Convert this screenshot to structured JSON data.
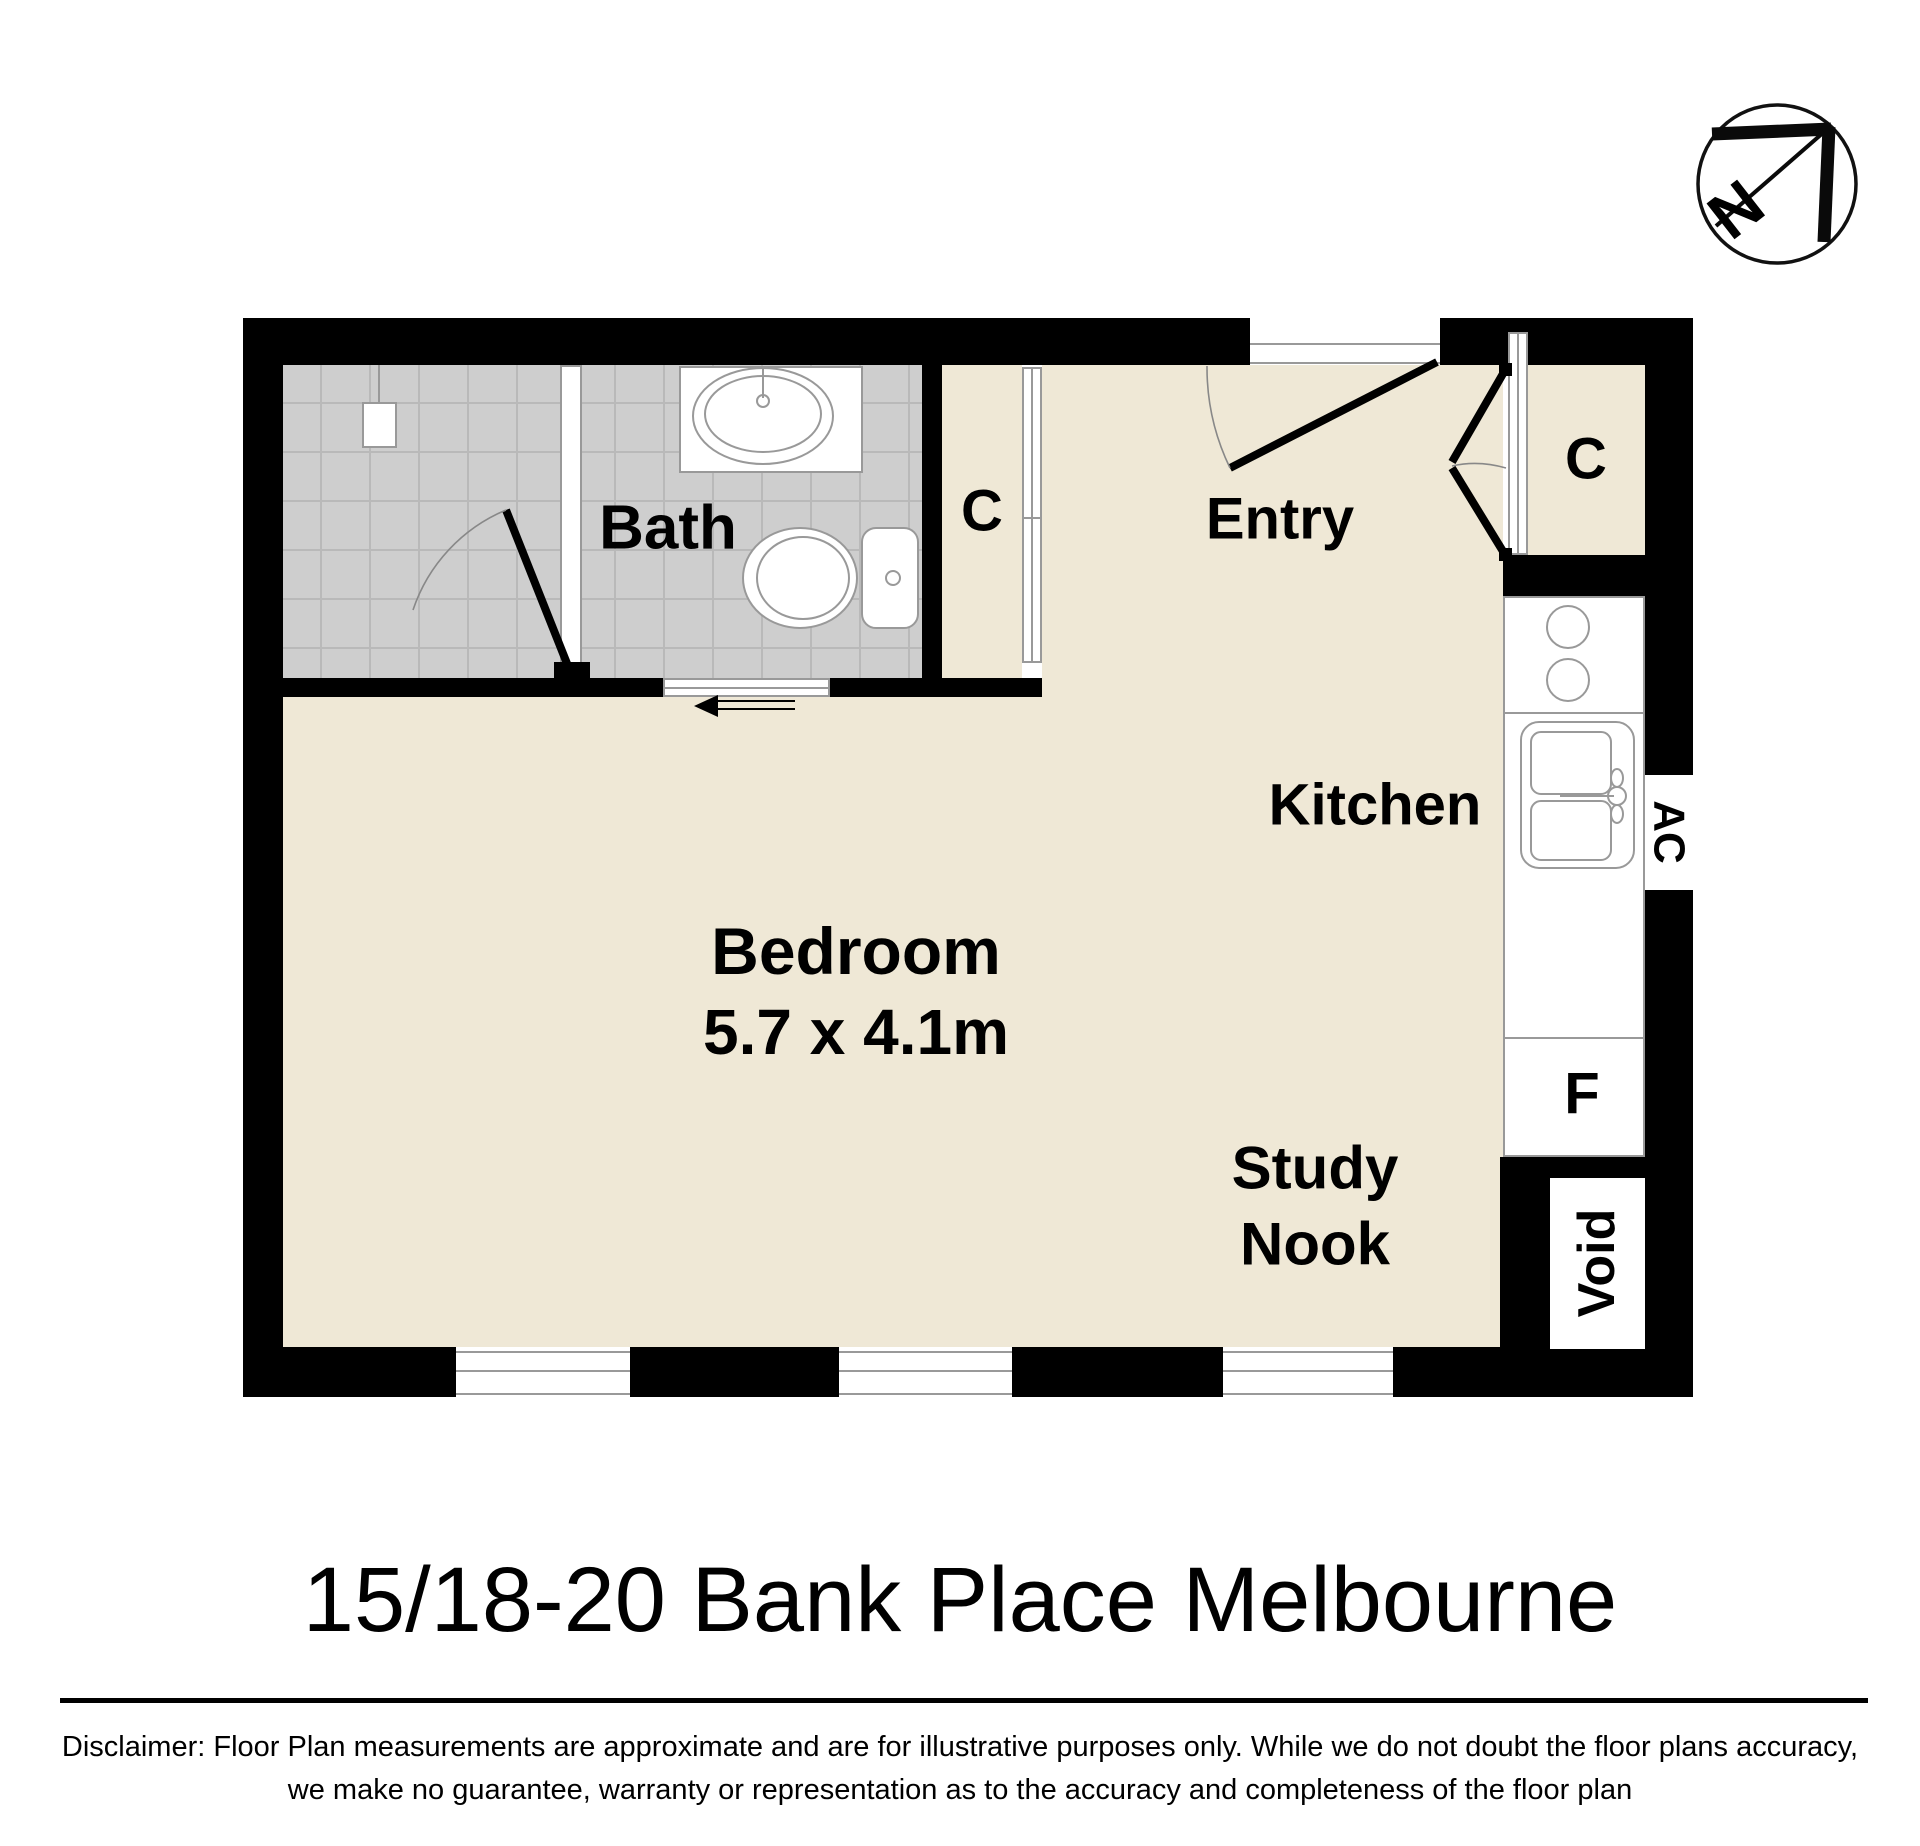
{
  "meta": {
    "title": "15/18-20 Bank Place Melbourne",
    "disclaimer_line1": "Disclaimer: Floor Plan measurements are approximate and are for illustrative purposes only. While we do not doubt the floor plans accuracy,",
    "disclaimer_line2": "we make no guarantee, warranty or representation as to the accuracy and completeness of the floor plan"
  },
  "compass": {
    "north_label": "N"
  },
  "rooms": {
    "bath": "Bath",
    "closet_bath": "C",
    "entry": "Entry",
    "closet_entry": "C",
    "kitchen": "Kitchen",
    "bedroom": "Bedroom",
    "bedroom_dims": "5.7 x 4.1m",
    "study_line1": "Study",
    "study_line2": "Nook",
    "fridge": "F",
    "ac": "AC",
    "void": "Void"
  },
  "colors": {
    "wall": "#000000",
    "floor": "#EFE8D6",
    "tile": "#CECECE",
    "grout": "#B9B9B9",
    "outline": "#999999",
    "paper": "#FFFFFF",
    "ink": "#000000"
  }
}
